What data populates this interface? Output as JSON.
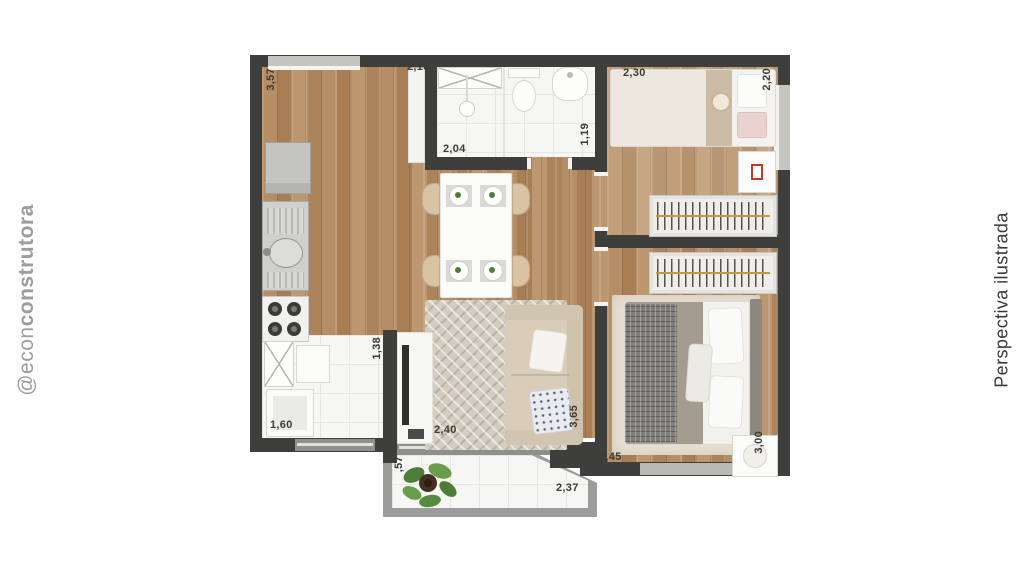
{
  "branding": {
    "handle_prefix": "@econ",
    "handle_suffix": "construtora",
    "caption_right": "Perspectiva ilustrada"
  },
  "dimensions": {
    "kitchen_height": "3,57",
    "kitchen_width": "2,18",
    "bathroom_width": "2,04",
    "bathroom_depth": "1,19",
    "bedroom1_width": "2,30",
    "bedroom1_depth": "2,20",
    "service_depth": "1,38",
    "service_width": "1,60",
    "living_width": "2,40",
    "living_depth": "3,65",
    "bedroom2_width": "2,45",
    "bedroom2_depth": "3,00",
    "balcony_depth": ",57",
    "balcony_width": "2,37"
  },
  "colors": {
    "wall": "#3e3e3c",
    "balcony_wall": "#9c9c9c",
    "hanger_rod": "#c39a3b",
    "label": "#3c3b35",
    "brand_gray": "#9d9d9d",
    "caption_dark": "#3a3a3a"
  }
}
